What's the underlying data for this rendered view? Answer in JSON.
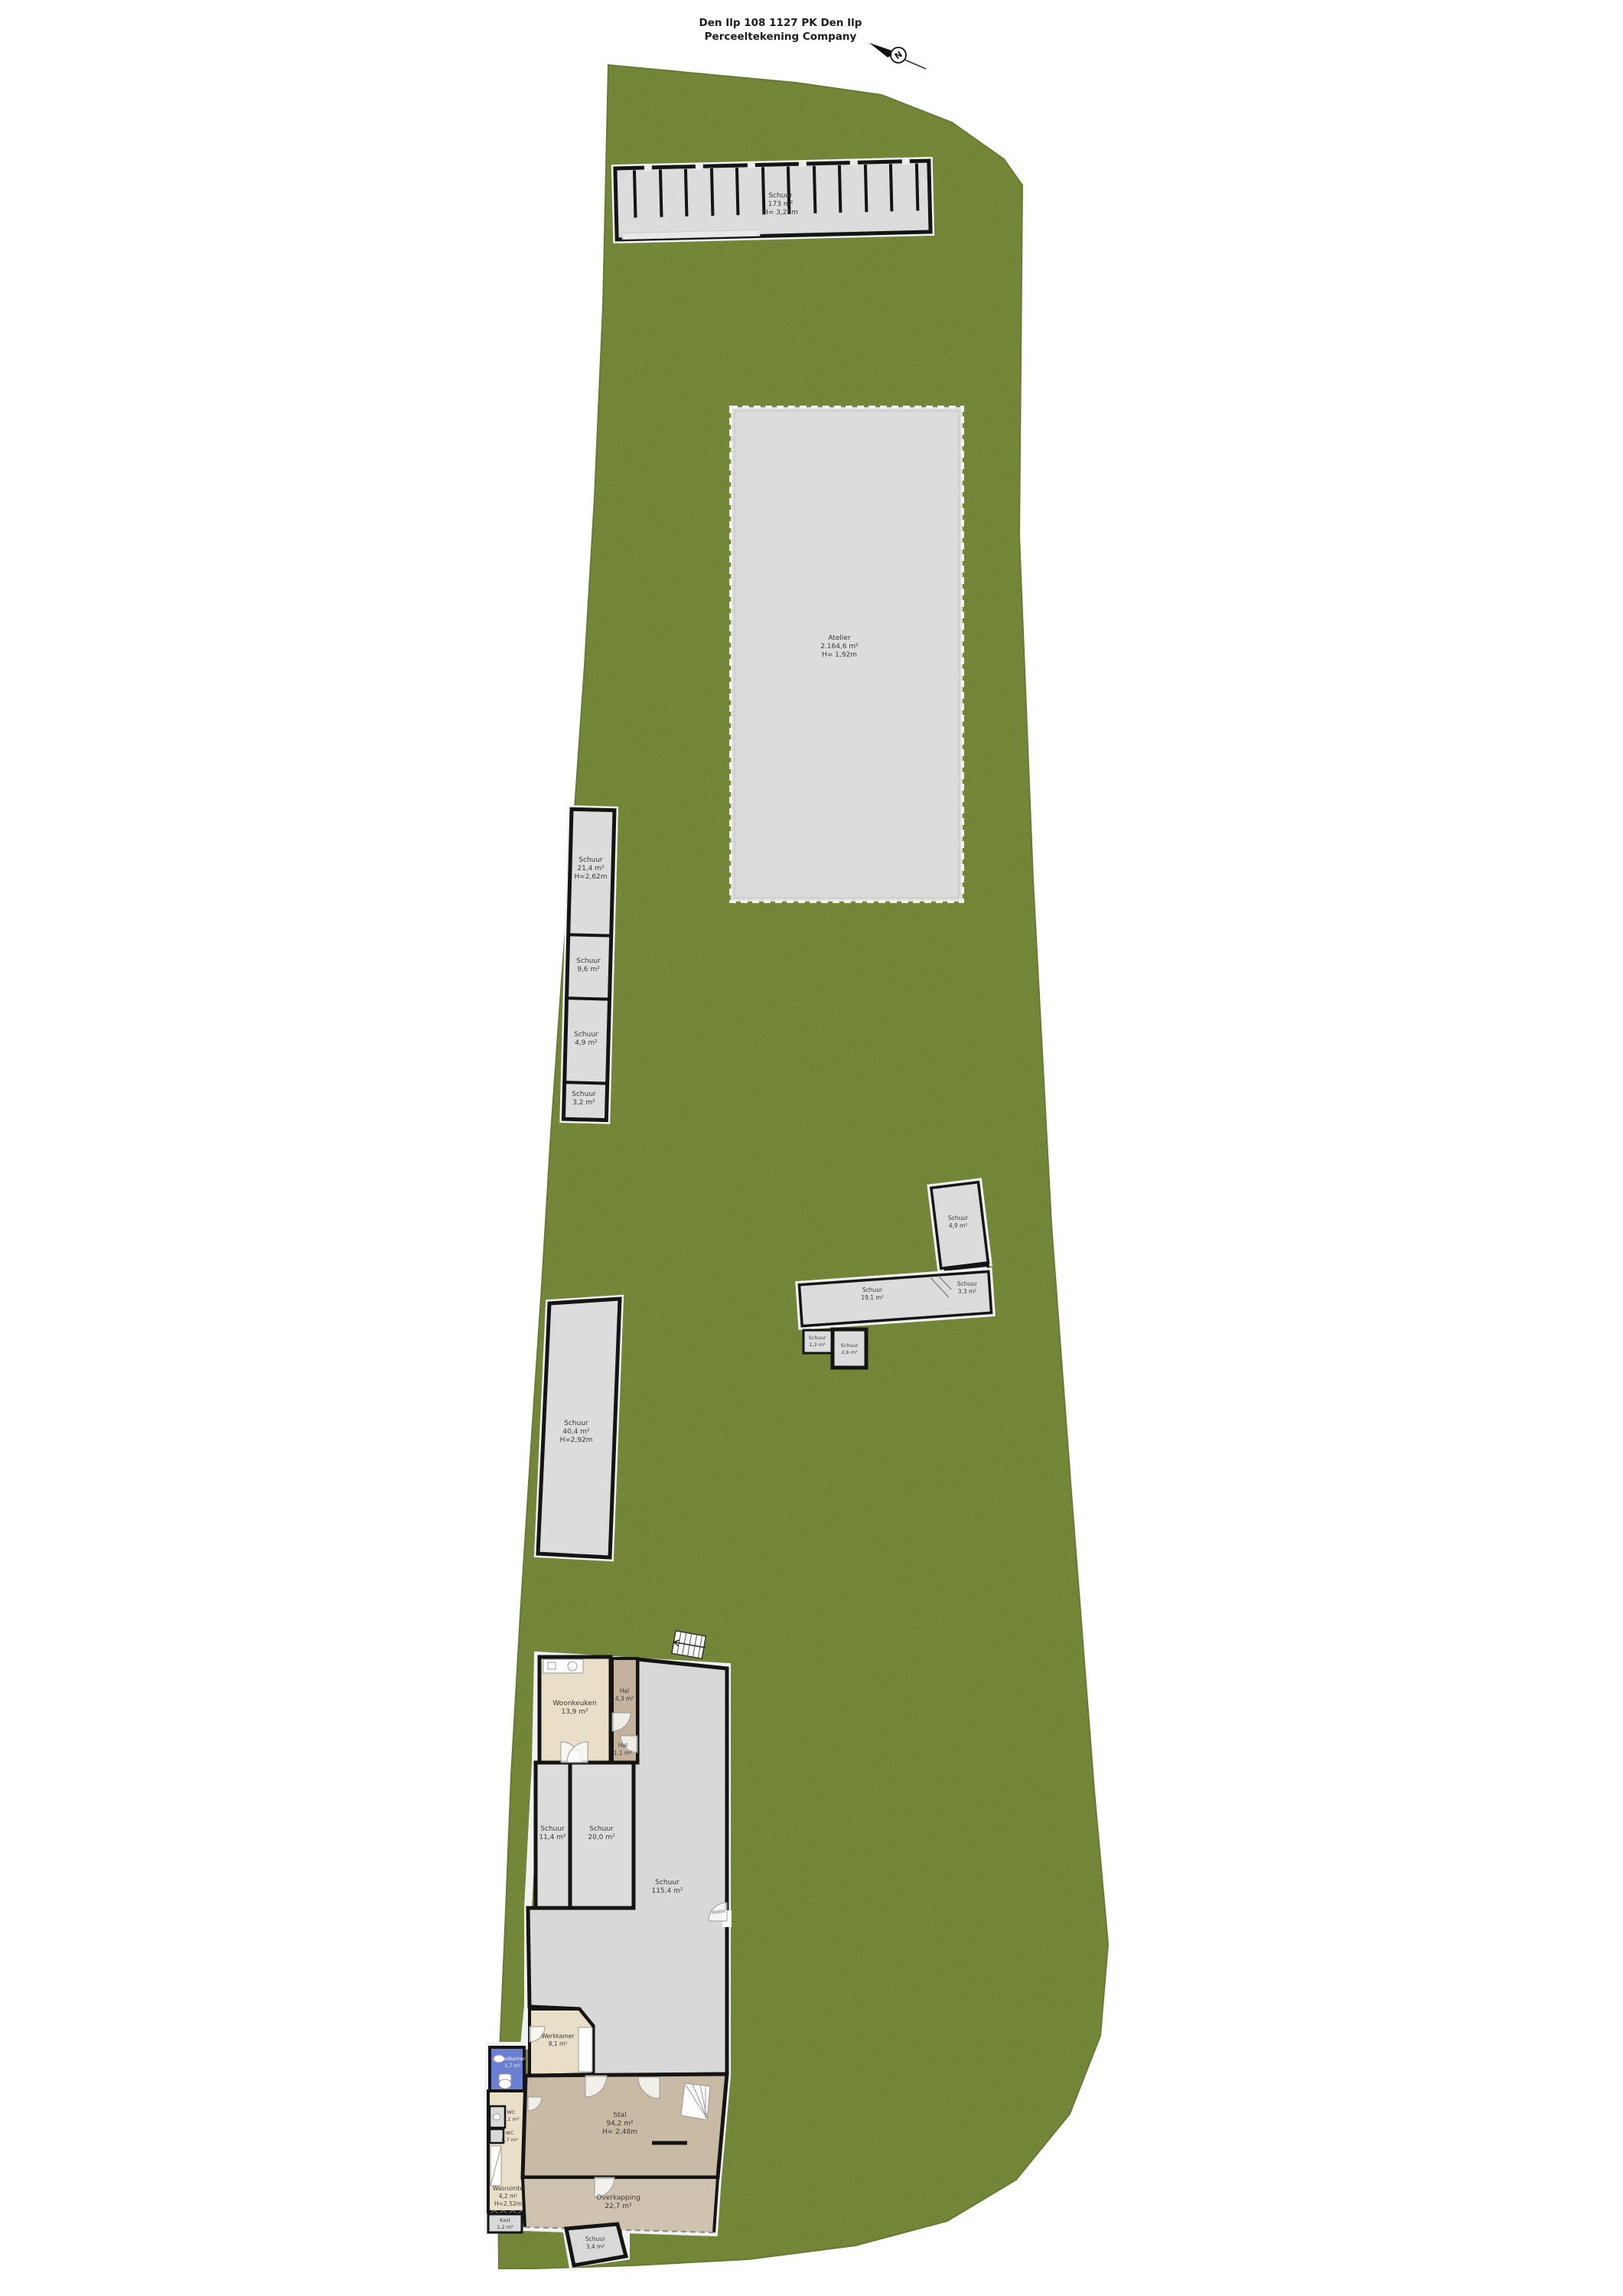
{
  "title": {
    "line1": "Den Ilp 108 1127 PK Den Ilp",
    "line2": "Perceeltekening Company"
  },
  "compass": {
    "label": "N"
  },
  "colors": {
    "grass": "#7d913d",
    "grass_speckle": "#55682a",
    "wall": "#141414",
    "shed_gray": "#dcdcdc",
    "beige": "#e9dfc7",
    "corridor_taupe": "#c4b29c",
    "stal_taupe": "#c9baa4",
    "overkapping_taupe": "#cfc2ae",
    "bathroom_blue": "#6b80d2"
  },
  "buildings": {
    "stable_block": {
      "name": "Schuur",
      "area": "173 m²",
      "height": "H= 3,28m"
    },
    "field_shed": {
      "name": "Atelier",
      "area": "2.164,6 m²",
      "height": "H= 1,92m"
    },
    "strip": [
      {
        "name": "Schuur",
        "area": "21,4 m²",
        "height": "H=2,62m"
      },
      {
        "name": "Schuur",
        "area": "9,6 m²"
      },
      {
        "name": "Schuur",
        "area": "4,9 m²"
      },
      {
        "name": "Schuur",
        "area": "3,2 m²"
      }
    ],
    "mid": {
      "a": {
        "name": "Schuur",
        "area": "4,9 m²"
      },
      "b": {
        "name": "Schuur",
        "area": "3,3 m²"
      },
      "c": {
        "name": "Schuur",
        "area": "19,1 m²"
      },
      "d": {
        "name": "Schuur",
        "area": "1,3 m²"
      },
      "e": {
        "name": "Schuur",
        "area": "2,6 m²"
      }
    },
    "barn": {
      "name": "Schuur",
      "area": "40,4 m²",
      "height": "H=2,92m"
    },
    "house": {
      "woonkeuken": {
        "name": "Woonkeuken",
        "area": "13,9 m²"
      },
      "hal1": {
        "name": "Hal",
        "area": "4,3 m²"
      },
      "hal2": {
        "name": "Hal",
        "area": "1,1 m²"
      },
      "kamer1": {
        "name": "Schuur",
        "area": "11,4 m²"
      },
      "kamer2": {
        "name": "Schuur",
        "area": "20,0 m²"
      },
      "garage": {
        "name": "Schuur",
        "area": "115,4 m²"
      },
      "werkkamer": {
        "name": "Werkkamer",
        "area": "8,1 m²"
      },
      "badkamer": {
        "name": "Badkamer",
        "area": "1,7 m²"
      },
      "wc1": {
        "name": "WC",
        "area": "1,1 m²"
      },
      "wc2": {
        "name": "WC",
        "area": "0,7 m²"
      },
      "wasruimte": {
        "name": "Wasruimte",
        "area": "4,2 m²",
        "height": "H=2,52m"
      },
      "kast": {
        "name": "Kast",
        "area": "1,2 m²"
      },
      "stal": {
        "name": "Stal",
        "area": "94,2 m²",
        "height": "H= 2,48m"
      },
      "overkapping": {
        "name": "Overkapping",
        "area": "22,7 m²"
      },
      "schuurtje": {
        "name": "Schuur",
        "area": "3,4 m²"
      }
    }
  }
}
